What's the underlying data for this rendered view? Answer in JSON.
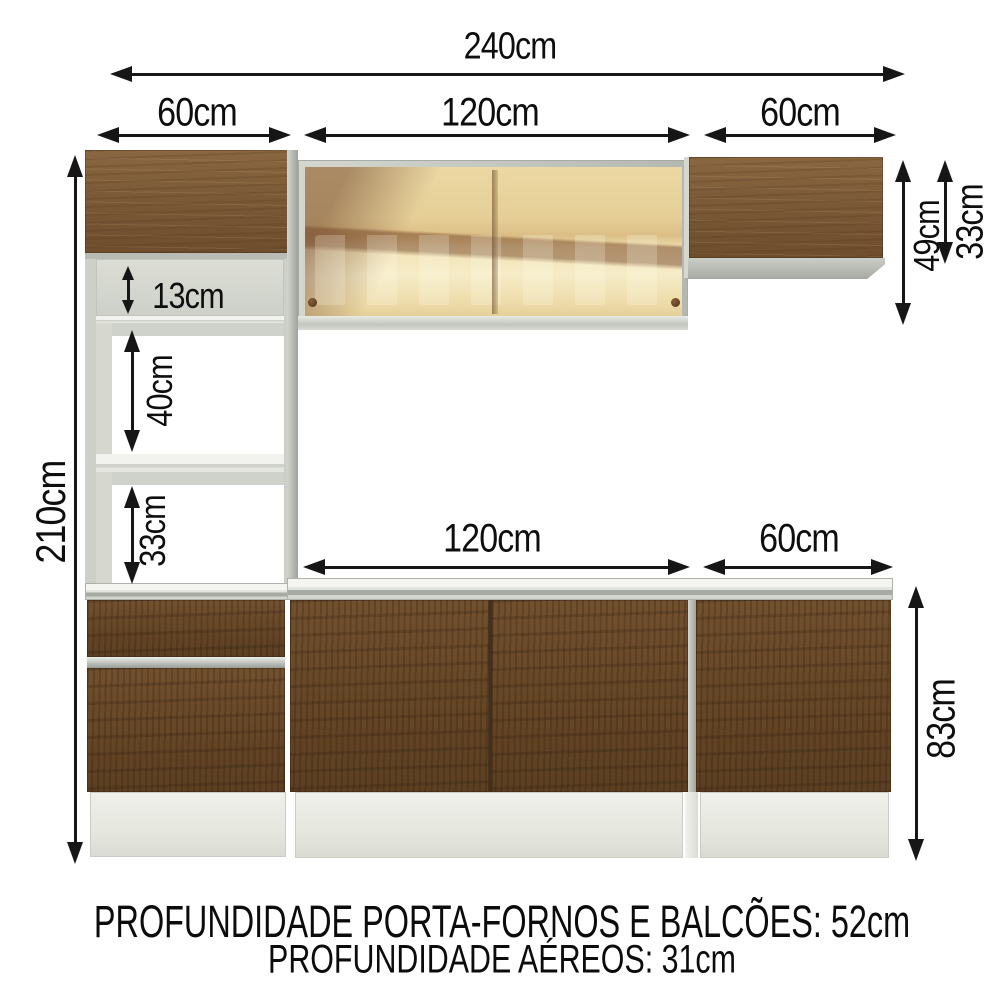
{
  "diagram": {
    "dimensions": {
      "total_width": "240cm",
      "upper_left_width": "60cm",
      "upper_middle_width": "120cm",
      "upper_right_width": "60cm",
      "overall_height": "210cm",
      "niche_top_height": "13cm",
      "niche_middle_height": "40cm",
      "niche_bottom_height": "33cm",
      "wall_cabinet_middle_height": "49cm",
      "wall_cabinet_right_height": "33cm",
      "base_middle_width": "120cm",
      "base_right_width": "60cm",
      "base_height": "83cm"
    },
    "footer": {
      "line1": "PROFUNDIDADE PORTA-FORNOS E BALCÕES: 52cm",
      "line2": "PROFUNDIDADE AÉREOS: 31cm"
    },
    "colors": {
      "wood_light": "#7d5c3a",
      "wood_dark": "#64452a",
      "frame_gray": "#c3c6bf",
      "plinth_white": "#e9eae3",
      "glass_amber": "#e8d19c",
      "dimension_black": "#141414"
    }
  }
}
